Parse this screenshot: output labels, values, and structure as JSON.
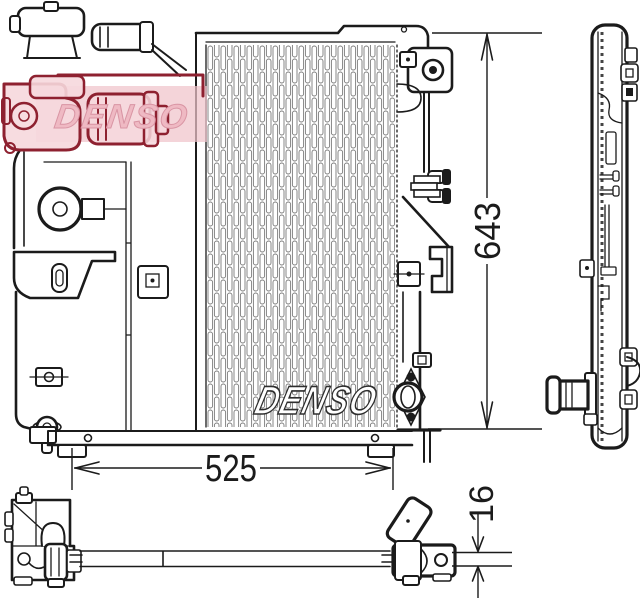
{
  "dimensions": {
    "height_mm": "643",
    "width_mm": "525",
    "depth_mm": "16"
  },
  "branding": {
    "core_logo": "DENSO",
    "stamp_logo": "DENSO"
  },
  "colors": {
    "line": "#1b1b1b",
    "fin_line": "#7a7a7a",
    "stamp_red": "#8e2130",
    "stamp_pink_fill": "#f6d8dd",
    "stamp_band": "#f0c3ca",
    "stamp_text": "#efb9c3",
    "background": "#ffffff"
  }
}
